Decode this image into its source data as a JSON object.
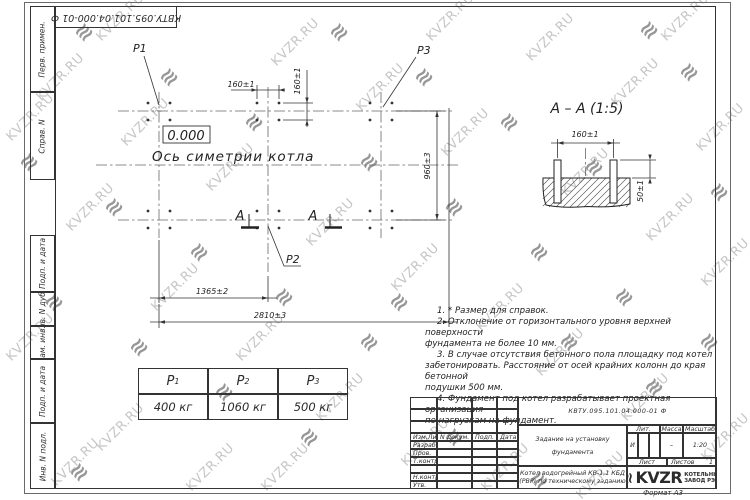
{
  "top_stamp": {
    "doc_number": "КВТУ.095.101.04.000-01 Ф"
  },
  "margin": {
    "labels": [
      "Перв. примен.",
      "Справ. N",
      "Подп. и дата",
      "Инв. N дубл.",
      "Взам. инв. N",
      "Подп. и дата",
      "Инв. N подл."
    ]
  },
  "plan": {
    "p1_label": "P1",
    "p2_label": "P2",
    "p3_label": "P3",
    "elevation": "0.000",
    "axis_label": "Ось симетрии котла",
    "section_letter": "А",
    "dim_160_top": "160±1",
    "dim_160_vert": "160±1",
    "dim_960": "960±3",
    "dim_1365": "1365±2",
    "dim_2810": "2810±3"
  },
  "section_view": {
    "title": "А – А (1:5)",
    "dim_160": "160±1",
    "dim_50": "50±1"
  },
  "notes": {
    "lines": [
      "1. * Размер для справок.",
      "2. Отклонение от горизонтального уровня верхней поверхности",
      "фундамента не более 10 мм.",
      "3. В случае отсутствия бетонного пола площадку под котел",
      "забетонировать. Расстояние от осей крайних колонн до края бетонной",
      "подушки 500 мм.",
      "4. Фундамент под котел разрабатывает проектная организация",
      "по нагрузкам на фундамент."
    ]
  },
  "load_table": {
    "headers": [
      {
        "name": "P",
        "sub": "1"
      },
      {
        "name": "P",
        "sub": "2"
      },
      {
        "name": "P",
        "sub": "3"
      }
    ],
    "values": [
      "400 кг",
      "1060 кг",
      "500 кг"
    ]
  },
  "title_block": {
    "doc_number": "КВТУ.095.101.04.000-01  Ф",
    "title": "Задание на установку фундамента",
    "product": "Котел водогрейный КВ-1,1 КБД (РВР) по техническому заданию",
    "col_headers": {
      "izm": "Изм.Лист",
      "doc": "N докум.",
      "podp": "Подп.",
      "data": "Дата"
    },
    "rows": [
      "Разраб.",
      "Пров.",
      "Т.контр.",
      "",
      "Н.контр.",
      "Утв."
    ],
    "lit_header": "Лит.",
    "mass_header": "Масса",
    "scale_header": "Масштаб",
    "lit_value": "И",
    "mass_value": "–",
    "scale_value": "1:20",
    "sheet_label": "Лист",
    "sheets_label": "Листов",
    "sheets_value": "1",
    "logo_glyph": "≋",
    "logo_name": "KVZR",
    "logo_sub1": "КОТЕЛЬНЫЙ",
    "logo_sub2": "ЗАВОД РЭП",
    "format_label": "Формат А3"
  },
  "watermark": {
    "text": "KVZR.RU",
    "glyph": "≋",
    "text_positions": [
      [
        30,
        70
      ],
      [
        115,
        115
      ],
      [
        200,
        160
      ],
      [
        60,
        200
      ],
      [
        0,
        330
      ],
      [
        145,
        280
      ],
      [
        230,
        330
      ],
      [
        90,
        420
      ],
      [
        180,
        460
      ],
      [
        265,
        35
      ],
      [
        350,
        80
      ],
      [
        435,
        125
      ],
      [
        300,
        215
      ],
      [
        385,
        260
      ],
      [
        470,
        300
      ],
      [
        310,
        390
      ],
      [
        395,
        435
      ],
      [
        255,
        460
      ],
      [
        520,
        30
      ],
      [
        605,
        75
      ],
      [
        690,
        120
      ],
      [
        555,
        165
      ],
      [
        640,
        210
      ],
      [
        695,
        255
      ],
      [
        530,
        345
      ],
      [
        615,
        390
      ],
      [
        695,
        430
      ],
      [
        475,
        460
      ],
      [
        570,
        468
      ],
      [
        90,
        10
      ],
      [
        420,
        10
      ],
      [
        655,
        10
      ],
      [
        0,
        110
      ],
      [
        45,
        455
      ]
    ],
    "glyph_positions": [
      [
        75,
        20
      ],
      [
        160,
        65
      ],
      [
        245,
        110
      ],
      [
        20,
        150
      ],
      [
        105,
        195
      ],
      [
        190,
        240
      ],
      [
        275,
        285
      ],
      [
        45,
        290
      ],
      [
        130,
        335
      ],
      [
        215,
        380
      ],
      [
        300,
        425
      ],
      [
        330,
        20
      ],
      [
        415,
        65
      ],
      [
        500,
        110
      ],
      [
        585,
        155
      ],
      [
        360,
        150
      ],
      [
        445,
        195
      ],
      [
        530,
        240
      ],
      [
        615,
        285
      ],
      [
        390,
        290
      ],
      [
        560,
        330
      ],
      [
        645,
        375
      ],
      [
        680,
        60
      ],
      [
        710,
        180
      ],
      [
        640,
        18
      ],
      [
        360,
        330
      ],
      [
        445,
        425
      ],
      [
        530,
        468
      ],
      [
        700,
        330
      ],
      [
        70,
        460
      ]
    ]
  }
}
